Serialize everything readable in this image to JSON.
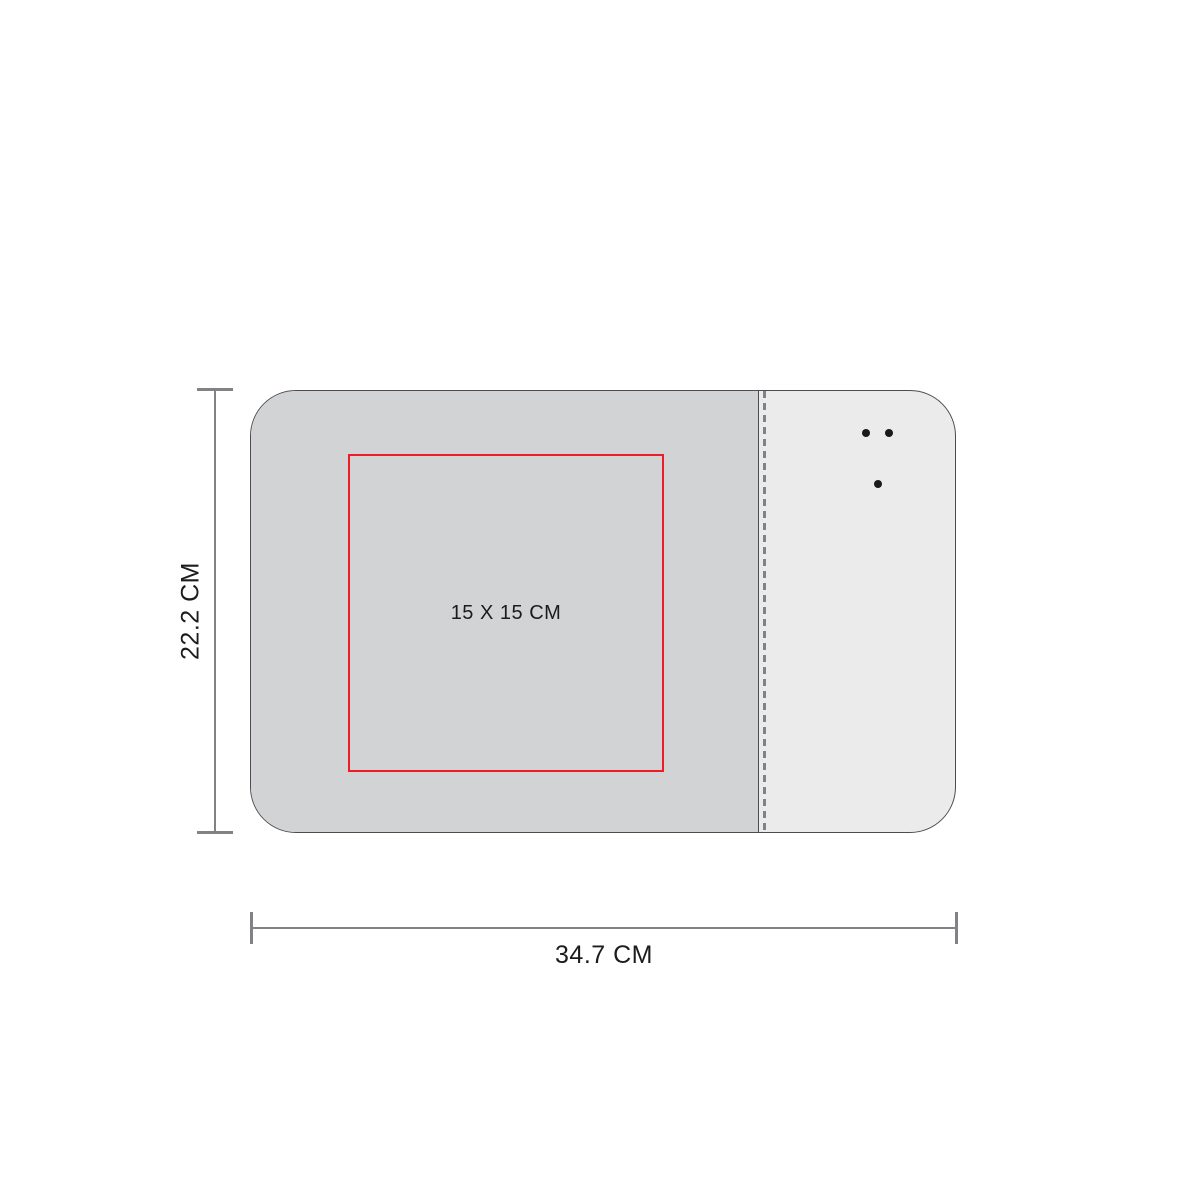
{
  "diagram": {
    "type": "product-dimension-diagram",
    "labels": {
      "height": "22.2 CM",
      "width": "34.7 CM",
      "print_area": "15 X 15 CM"
    },
    "colors": {
      "pad_fill": "#d2d3d4",
      "panel_fill": "#ebebec",
      "outline": "#4d4d4f",
      "dim_line": "#808285",
      "print_area_stroke": "#ee1c25",
      "text": "#1c1c1c",
      "dot": "#1a1a1a"
    }
  }
}
